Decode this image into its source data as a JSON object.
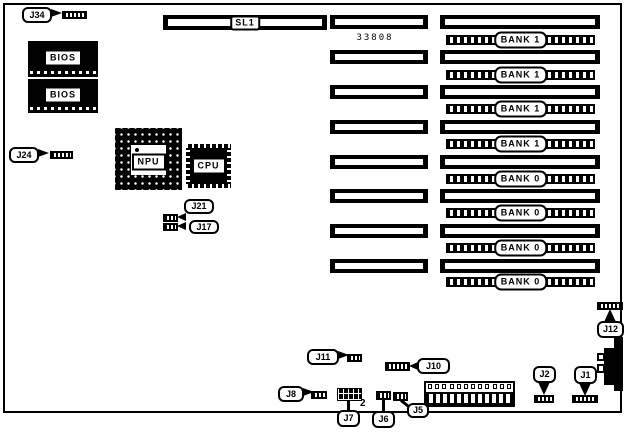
{
  "board": {
    "part_number": "33808",
    "pin2_marker": "2",
    "slot": {
      "label": "SL1"
    },
    "bios": [
      {
        "label": "BIOS"
      },
      {
        "label": "BIOS"
      }
    ],
    "chips": {
      "npu": "NPU",
      "cpu": "CPU"
    },
    "banks": [
      {
        "label": "BANK 1"
      },
      {
        "label": "BANK 1"
      },
      {
        "label": "BANK 1"
      },
      {
        "label": "BANK 1"
      },
      {
        "label": "BANK 0"
      },
      {
        "label": "BANK 0"
      },
      {
        "label": "BANK 0"
      },
      {
        "label": "BANK 0"
      }
    ],
    "jumpers": {
      "j34": {
        "label": "J34"
      },
      "j24": {
        "label": "J24"
      },
      "j21": {
        "label": "J21"
      },
      "j17": {
        "label": "J17"
      },
      "j11": {
        "label": "J11"
      },
      "j10": {
        "label": "J10"
      },
      "j8": {
        "label": "J8"
      },
      "j7": {
        "label": "J7"
      },
      "j6": {
        "label": "J6"
      },
      "j5": {
        "label": "J5"
      },
      "j2": {
        "label": "J2"
      },
      "j1": {
        "label": "J1"
      },
      "j12": {
        "label": "J12"
      }
    },
    "colors": {
      "ink": "#000000",
      "board": "#ffffff"
    }
  }
}
